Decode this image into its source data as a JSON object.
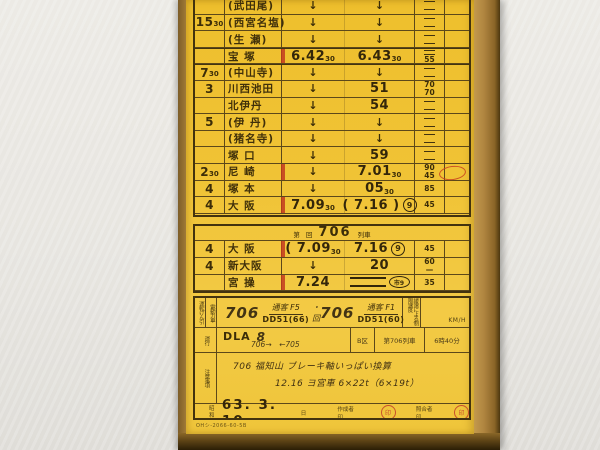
{
  "colors": {
    "card_yellow": "#f0c335",
    "line_brown": "#43330e",
    "stamp_red": "#c8502c",
    "stop_red": "#c23a1e"
  },
  "timetable_main": {
    "rows": [
      {
        "run": "",
        "station": "(武田尾)",
        "arr": "↓",
        "dep": "↓",
        "lim": [
          "="
        ]
      },
      {
        "run": "15",
        "run_sub": "30",
        "station": "(西宮名塩)",
        "arr": "↓",
        "dep": "↓",
        "lim": [
          "="
        ]
      },
      {
        "run": "",
        "station": "(生 瀬)",
        "arr": "↓",
        "dep": "↓",
        "lim": [
          "="
        ]
      },
      {
        "run": "",
        "station": "宝 塚",
        "stop": true,
        "bold_top": true,
        "arr": "6.42",
        "arr_sub": "30",
        "dep": "6.43",
        "dep_sub": "30",
        "lim": [
          "=",
          "55"
        ]
      },
      {
        "run": "7",
        "run_sub": "30",
        "station": "(中山寺)",
        "bold_top": true,
        "arr": "↓",
        "dep": "↓",
        "lim": [
          "="
        ]
      },
      {
        "run": "3",
        "station": "川西池田",
        "arr": "↓",
        "dep": "51",
        "lim": [
          "70",
          "70"
        ]
      },
      {
        "run": "",
        "station": "北伊丹",
        "arr": "↓",
        "dep": "54",
        "lim": [
          "="
        ]
      },
      {
        "run": "5",
        "station": "(伊 丹)",
        "arr": "↓",
        "dep": "↓",
        "lim": [
          "="
        ]
      },
      {
        "run": "",
        "station": "(猪名寺)",
        "arr": "↓",
        "dep": "↓",
        "lim": [
          "="
        ]
      },
      {
        "run": "",
        "station": "塚 口",
        "arr": "↓",
        "dep": "59",
        "lim": [
          "="
        ]
      },
      {
        "run": "2",
        "run_sub": "30",
        "station": "尼 崎",
        "stop": true,
        "arr": "↓",
        "dep": "7.01",
        "dep_sub": "30",
        "lim": [
          "90",
          "45"
        ],
        "stamp": true
      },
      {
        "run": "4",
        "station": "塚 本",
        "arr": "↓",
        "dep": "05",
        "dep_sub": "30",
        "lim": [
          "85"
        ]
      },
      {
        "run": "4",
        "station": "大 阪",
        "stop": true,
        "arr": "7.09",
        "arr_sub": "30",
        "dep": "( 7.16 )",
        "track": "9",
        "lim": [
          "45"
        ]
      }
    ]
  },
  "timetable_706": {
    "header": {
      "prefix": "第",
      "mid": "回",
      "number": "706",
      "suffix": "列車"
    },
    "rows": [
      {
        "run": "4",
        "station": "大 阪",
        "stop": true,
        "arr": "( 7.09",
        "arr_sub": "30",
        "dep": "7.16",
        "track": "9",
        "lim": [
          "45"
        ]
      },
      {
        "run": "4",
        "station": "新大阪",
        "arr": "↓",
        "dep": "20",
        "lim": [
          "60",
          "—"
        ]
      },
      {
        "run": "",
        "station": "宮 操",
        "stop": true,
        "arr": "7.24",
        "dep": "==",
        "circle": "市9",
        "lim": [
          "35"
        ]
      }
    ]
  },
  "info": {
    "loco_row": {
      "label1": "運転けん引",
      "label2": "電動力車",
      "train1": "706",
      "type1": "通客 F5",
      "loco1": "DD51(66)",
      "sep": "・回",
      "train2": "706",
      "type2": "通客 F1",
      "loco2": "DD51(60)",
      "limit_label": "緩速による制限速度",
      "unit": "KM/H"
    },
    "duty_row": {
      "label": "運行",
      "dla": "DLA",
      "dla_no": "8",
      "note": "706→　←705",
      "cell1": "B区",
      "cell2": "第706列車",
      "cell3": "6時40分"
    },
    "notes_row": {
      "label": "注意事項",
      "line1": "706 福知山 ブレーキ軸いっぱい換算",
      "line2": "12.16 ヨ宮車 6×22t（6×19t）"
    },
    "date_row": {
      "era": "昭和",
      "date": "63. 3. 10",
      "day": "日",
      "maker": "作成者 印",
      "checker": "照合者印"
    },
    "form_no": "OHシ-2066-60-5B"
  }
}
